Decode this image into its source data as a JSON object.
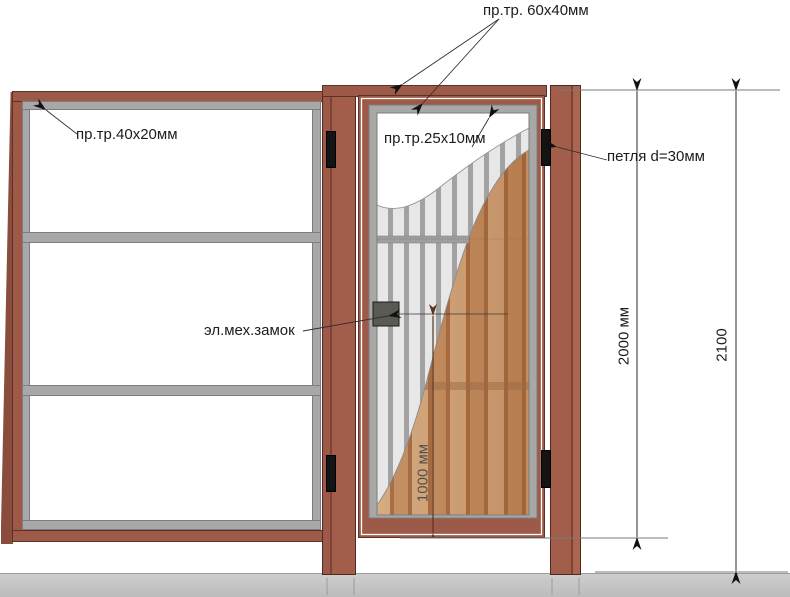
{
  "drawing": {
    "type": "gate-and-fence-technical-drawing",
    "labels": {
      "tube_60x40": "пр.тр. 60х40мм",
      "tube_40x20": "пр.тр.40х20мм",
      "tube_25x10": "пр.тр.25х10мм",
      "hinge": "петля d=30мм",
      "lock": "эл.мех.замок"
    },
    "dimensions": {
      "gate_height": "2000 мм",
      "total_height": "2100",
      "lock_to_bottom": "1000 мм"
    },
    "colors": {
      "frame_brown": "#9e5a48",
      "steel_gray": "#a8a8a8",
      "ground_gray": "#c7c7c7",
      "hinge_black": "#141414",
      "slat_light": "#d6ac82",
      "slat_mid": "#c69266",
      "slat_gap": "#a96f47",
      "dim_brown": "#5a3423"
    }
  }
}
